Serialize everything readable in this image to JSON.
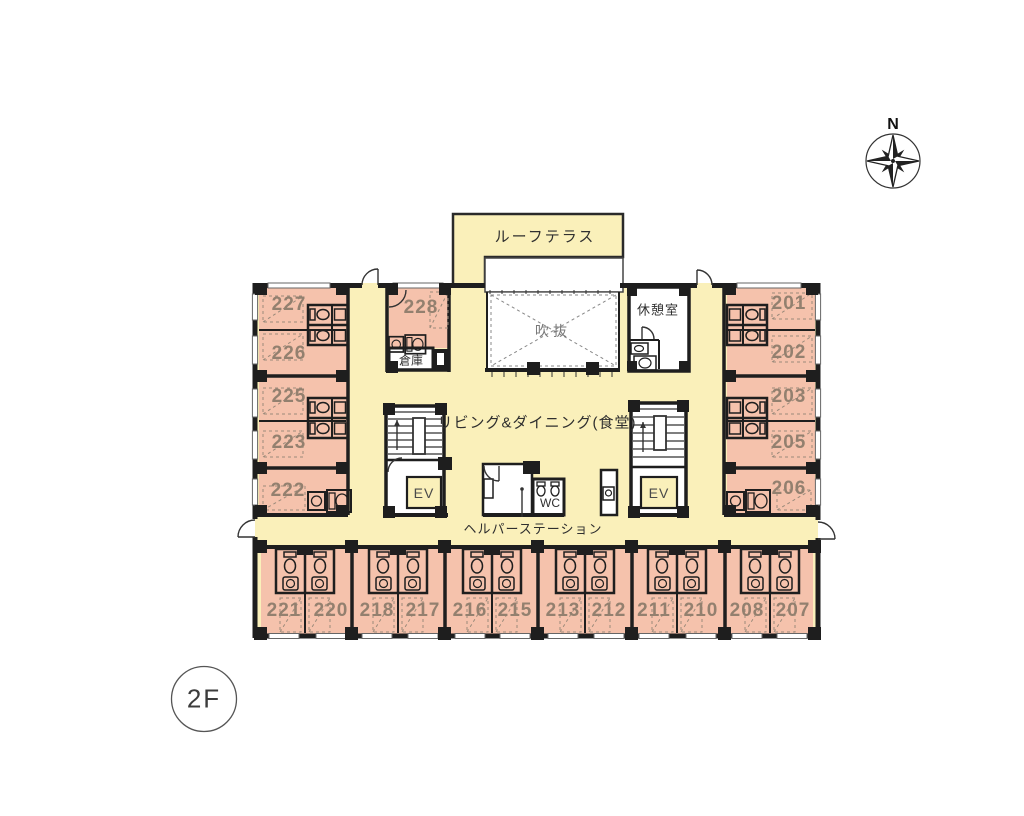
{
  "floor": {
    "label": "2F"
  },
  "compass": {
    "north": "N"
  },
  "areas": {
    "roof_terrace": "ルーフテラス",
    "atrium": "吹抜",
    "rest_room": "休憩室",
    "living_dining": "リビング&ダイニング(食堂)",
    "storage": "倉庫",
    "wc": "WC",
    "elevator": "EV",
    "helper_station": "ヘルパーステーション"
  },
  "rooms": {
    "r201": "201",
    "r202": "202",
    "r203": "203",
    "r205": "205",
    "r206": "206",
    "r207": "207",
    "r208": "208",
    "r210": "210",
    "r211": "211",
    "r212": "212",
    "r213": "213",
    "r215": "215",
    "r216": "216",
    "r217": "217",
    "r218": "218",
    "r220": "220",
    "r221": "221",
    "r222": "222",
    "r223": "223",
    "r225": "225",
    "r226": "226",
    "r227": "227",
    "r228": "228"
  },
  "colors": {
    "room_fill": "#f5c2ac",
    "common_fill": "#faf0ba",
    "wall": "#1e1e1e",
    "room_number": "#93806f"
  }
}
